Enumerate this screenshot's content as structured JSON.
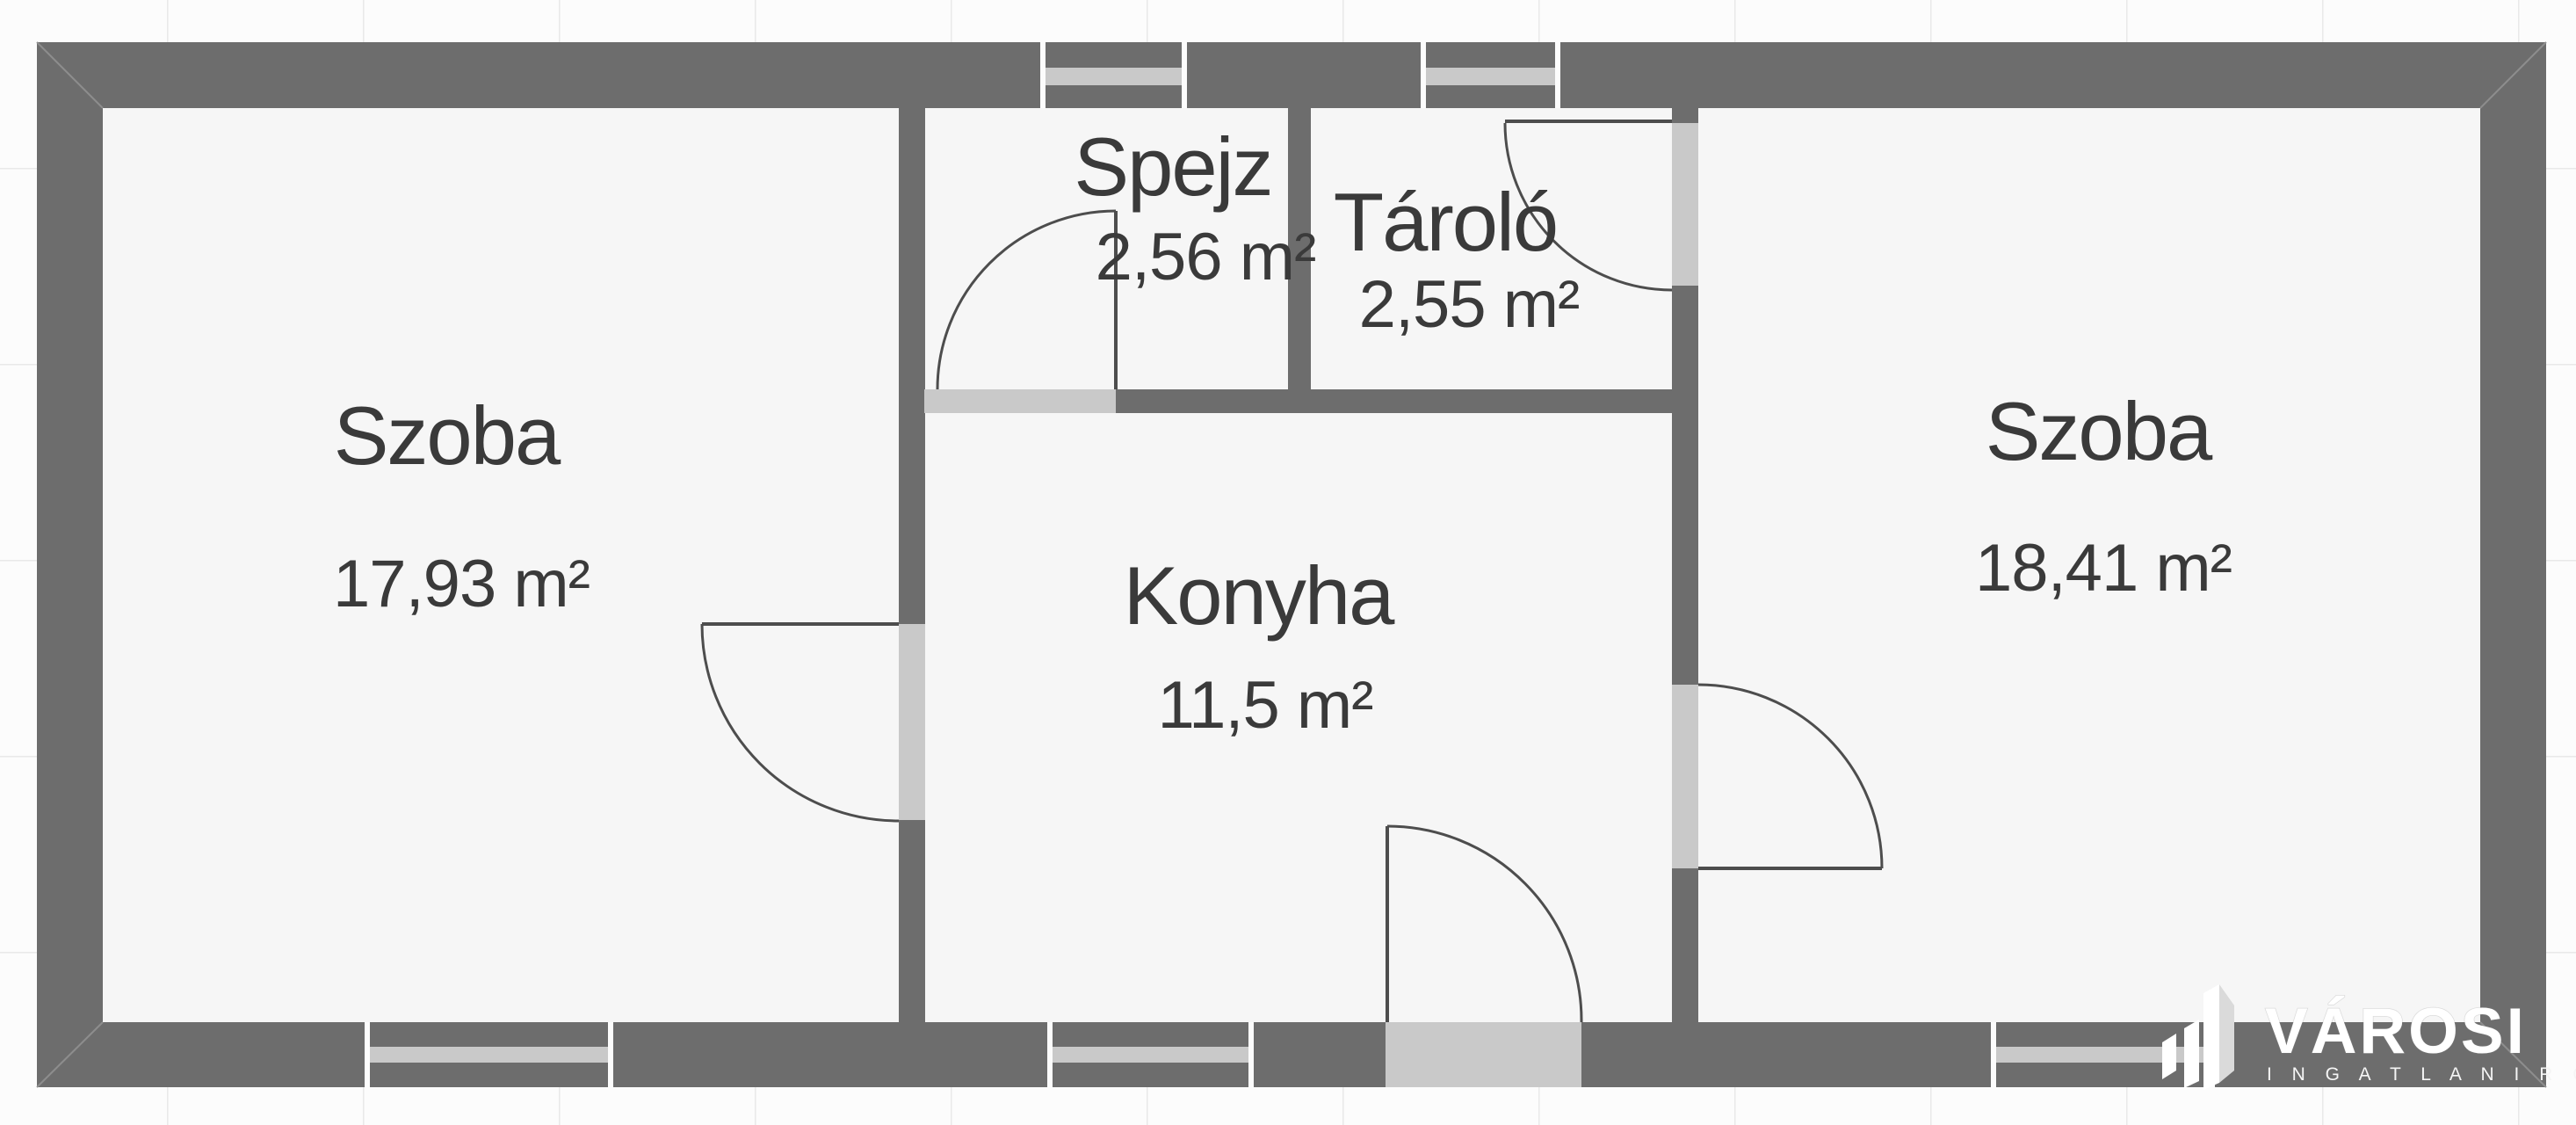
{
  "plan": {
    "rooms": [
      {
        "id": "szoba-left",
        "name": "Szoba",
        "area": "17,93 m²"
      },
      {
        "id": "spejz",
        "name": "Spejz",
        "area": "2,56 m²"
      },
      {
        "id": "tarolo",
        "name": "Tároló",
        "area": "2,55 m²"
      },
      {
        "id": "konyha",
        "name": "Konyha",
        "area": "11,5 m²"
      },
      {
        "id": "szoba-right",
        "name": "Szoba",
        "area": "18,41 m²"
      }
    ]
  },
  "branding": {
    "name": "VÁROSI",
    "subtitle": "I N G A T L A N I R O D A"
  },
  "colors": {
    "wall": "#6d6d6d",
    "floor": "#f6f6f6",
    "background": "#fcfcfc",
    "grid_line": "#e9e9e9",
    "threshold": "#c9c9c9",
    "label_text": "#3a3a3a",
    "logo": "#ffffff"
  }
}
